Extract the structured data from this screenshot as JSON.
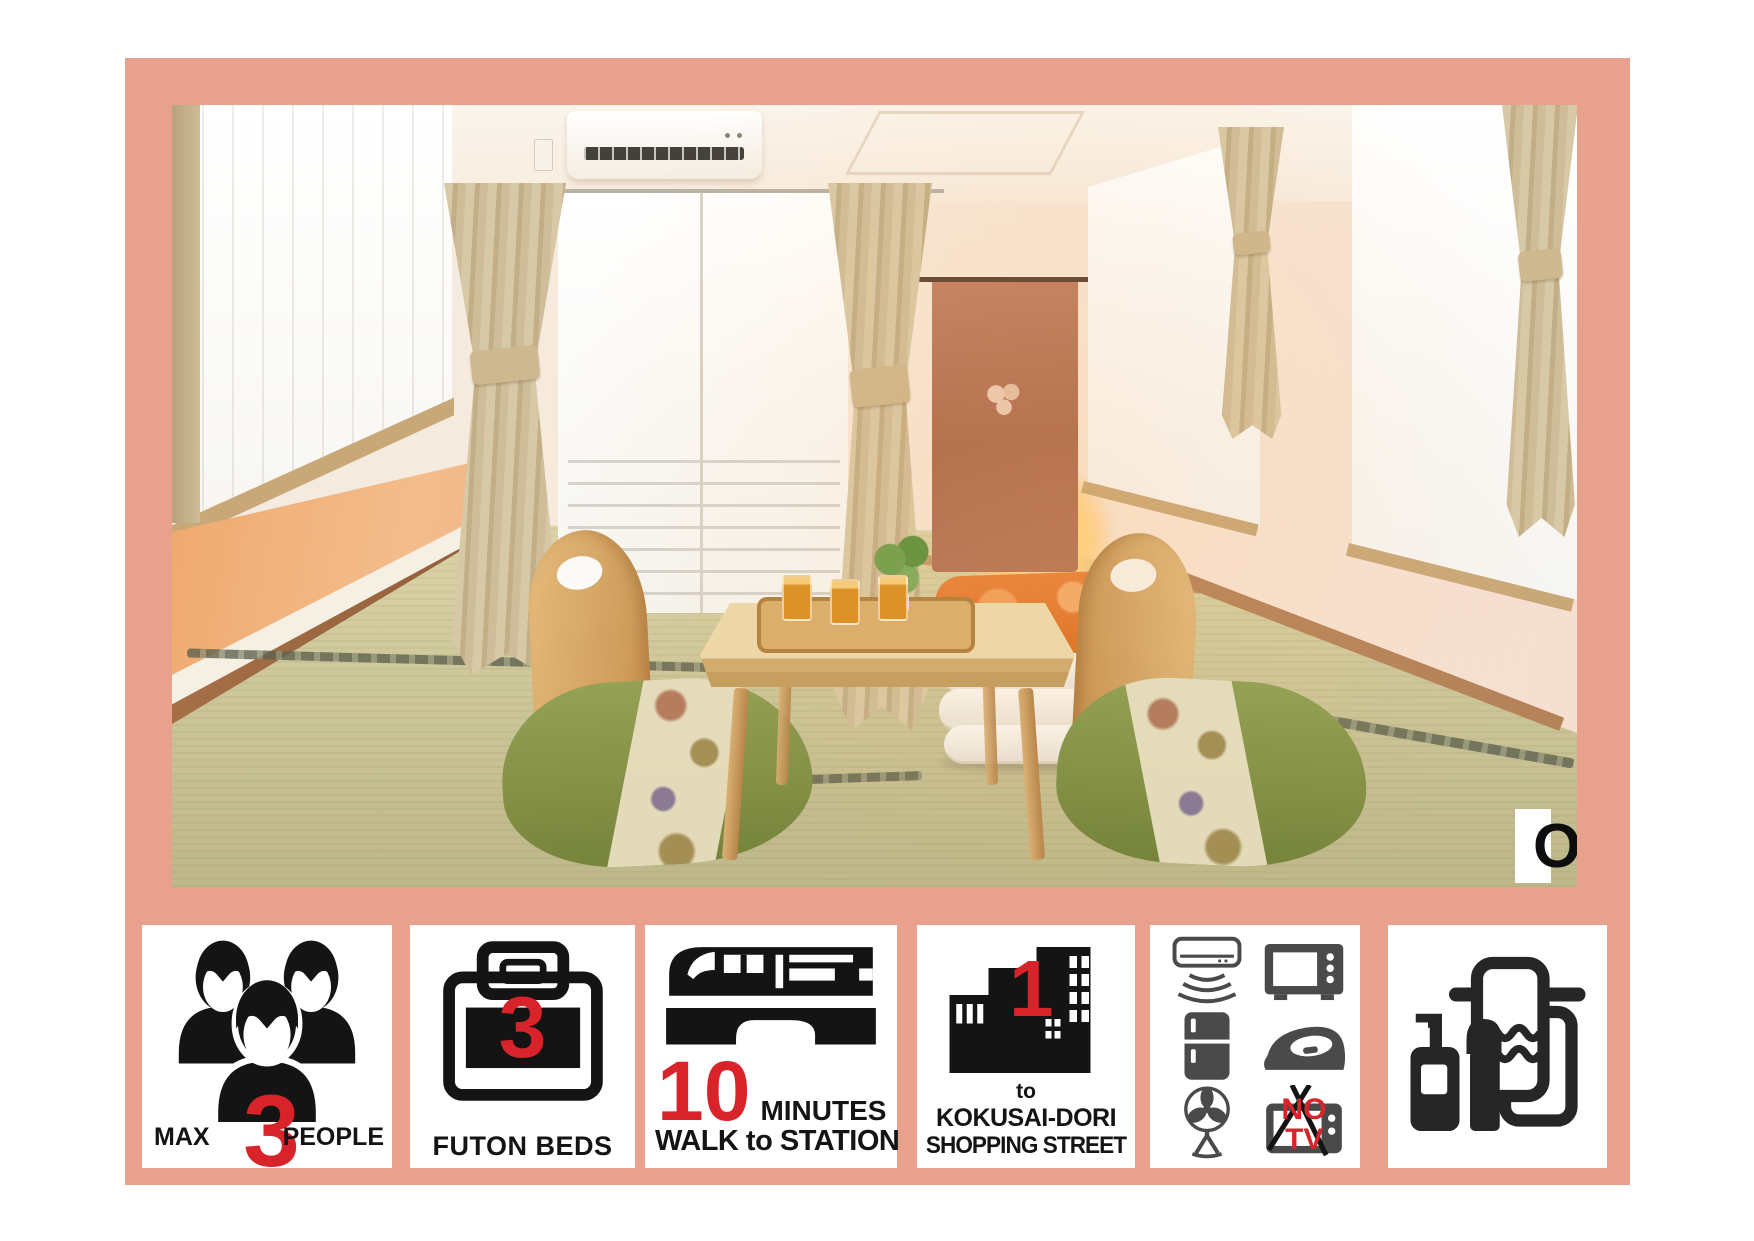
{
  "colors": {
    "frame_salmon": "#E8A18C",
    "accent_red": "#D8232B",
    "icon_black": "#141414",
    "icon_gray": "#4A4A4A"
  },
  "photo": {
    "floor_label": "On the 3rd floor"
  },
  "badges": {
    "people": {
      "max": "MAX",
      "count": "3",
      "label": "PEOPLE"
    },
    "futon": {
      "count": "3",
      "label": "FUTON BEDS"
    },
    "station": {
      "count": "10",
      "unit": "MINUTES",
      "label": "WALK to STATION"
    },
    "shopping": {
      "count": "1",
      "line1": "MINUTE",
      "line2": "to",
      "line3": "KOKUSAI-DORI",
      "line4": "SHOPPING STREET"
    },
    "appliances": {
      "no": "NO",
      "tv": "TV"
    }
  },
  "icons": [
    "people-icon",
    "futon-icon",
    "train-icon",
    "buildings-icon",
    "ac-icon",
    "microwave-icon",
    "fridge-icon",
    "iron-icon",
    "fan-icon",
    "no-tv-icon",
    "towel-amenities-icon"
  ]
}
